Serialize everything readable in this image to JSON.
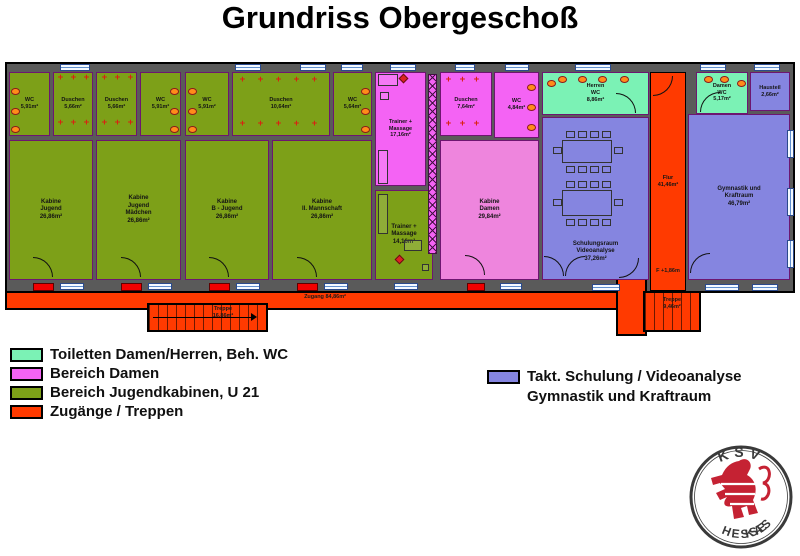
{
  "title": "Grundriss Obergeschoß",
  "colors": {
    "toilets_mint": "#7bf2b5",
    "damen_pink": "#f463f4",
    "jugend_olive": "#7da018",
    "zugang_orange": "#ff3a00",
    "schulung_blue": "#8585e0",
    "wall_gray": "#5a5a5a",
    "threshold_red": "#f20000",
    "window_blue": "#5f8fd0",
    "lion_red": "#c52233"
  },
  "rooms": {
    "wcA": {
      "label": "WC\n5,91m²"
    },
    "duA": {
      "label": "Duschen\n5,66m²"
    },
    "duB": {
      "label": "Duschen\n5,66m²"
    },
    "wcB": {
      "label": "WC\n5,91m²"
    },
    "wcC": {
      "label": "WC\n5,91m²"
    },
    "duC": {
      "label": "Duschen\n10,64m²"
    },
    "wcD": {
      "label": "WC\n5,64m²"
    },
    "kab1": {
      "label": "Kabine\nJugend\n26,86m²"
    },
    "kab2": {
      "label": "Kabine\nJugend\nMädchen\n26,86m²"
    },
    "kab3": {
      "label": "Kabine\nB - Jugend\n26,86m²"
    },
    "kab4": {
      "label": "Kabine\nII. Mannschaft\n26,86m²"
    },
    "trainerPink": {
      "label": "Trainer +\nMassage\n17,16m²"
    },
    "duDamen": {
      "label": "Duschen\n7,64m²"
    },
    "wcDamenPink": {
      "label": "WC\n4,84m²"
    },
    "kabDamen": {
      "label": "Kabine\nDamen\n29,84m²"
    },
    "trainerGreen": {
      "label": "Trainer +\nMassage\n14,16m²"
    },
    "herrenWC": {
      "label": "Herren\nWC\n8,86m²"
    },
    "damenWC": {
      "label": "Damen\nWC\n5,17m²"
    },
    "hausteil": {
      "label": "Hausteil\n2,66m²"
    },
    "flur": {
      "label": "Flur\n41,46m²"
    },
    "schulung": {
      "label": "Schulungsraum\nVideoanalyse\n37,26m²"
    },
    "gym": {
      "label": "Gymnastik und\nKraftraum\n46,79m²"
    },
    "zugang": {
      "label": "Zugang 84,86m²"
    },
    "treppeL": {
      "label": "Treppe\n16,86m²"
    },
    "treppeR": {
      "label": "Treppe\n9,46m²"
    },
    "level": {
      "label": "F +1,86m"
    }
  },
  "legend": {
    "left": [
      {
        "label": "Toiletten Damen/Herren, Beh. WC",
        "color": "#7bf2b5"
      },
      {
        "label": "Bereich Damen",
        "color": "#f463f4"
      },
      {
        "label": "Bereich Jugendkabinen, U 21",
        "color": "#7da018"
      },
      {
        "label": "Zugänge / Treppen",
        "color": "#ff3a00"
      }
    ],
    "right": {
      "color": "#8585e0",
      "line1": "Takt. Schulung / Videoanalyse",
      "line2": "Gymnastik und Kraftraum"
    }
  },
  "logo": {
    "top": "KSV",
    "bottom_left": "HESSEN",
    "bottom_right": "KASSEL"
  }
}
